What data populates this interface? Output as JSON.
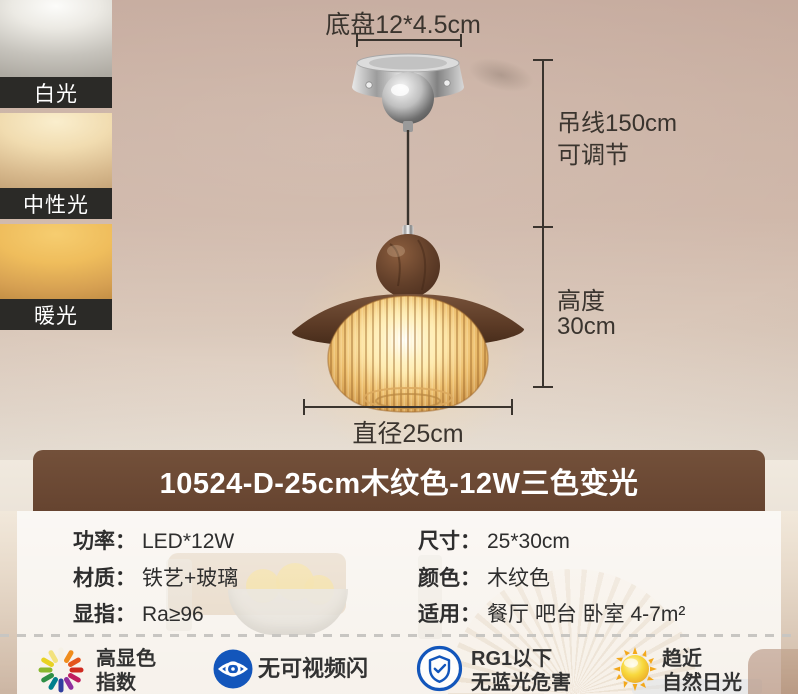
{
  "light_modes": [
    {
      "label": "白光"
    },
    {
      "label": "中性光"
    },
    {
      "label": "暖光"
    }
  ],
  "diagram": {
    "base_dim": "底盘12*4.5cm",
    "wire_line1": "吊线150cm",
    "wire_line2": "可调节",
    "height_line1": "高度",
    "height_line2": "30cm",
    "diameter_dim": "直径25cm"
  },
  "banner": {
    "title": "10524-D-25cm木纹色-12W三色变光"
  },
  "specs": {
    "left": [
      {
        "label": "功率：",
        "value": "LED*12W"
      },
      {
        "label": "材质：",
        "value": "铁艺+玻璃"
      },
      {
        "label": "显指：",
        "value": "Ra≥96"
      }
    ],
    "right": [
      {
        "label": "尺寸：",
        "value": "25*30cm"
      },
      {
        "label": "颜色：",
        "value": "木纹色"
      },
      {
        "label": "适用：",
        "value": "餐厅 吧台 卧室 4-7m²"
      }
    ]
  },
  "features": [
    {
      "icon": "high-cri-burst-icon",
      "line1": "高显色",
      "line2": "指数"
    },
    {
      "icon": "no-flicker-eye-icon",
      "line1": "无可视频闪",
      "line2": ""
    },
    {
      "icon": "blue-light-shield-icon",
      "line1": "RG1以下",
      "line2": "无蓝光危害"
    },
    {
      "icon": "daylight-sun-icon",
      "line1": "趋近",
      "line2": "自然日光"
    }
  ],
  "colors": {
    "wall_tan": "#cbb2a4",
    "banner_brown": "#6b4733",
    "label_bar_dark": "#2b2a27",
    "accent_blue": "#1356bb",
    "sun_gold": "#f3a81c",
    "glass_amber": "#e8bc6a",
    "wood_brown": "#5f3e2a"
  }
}
